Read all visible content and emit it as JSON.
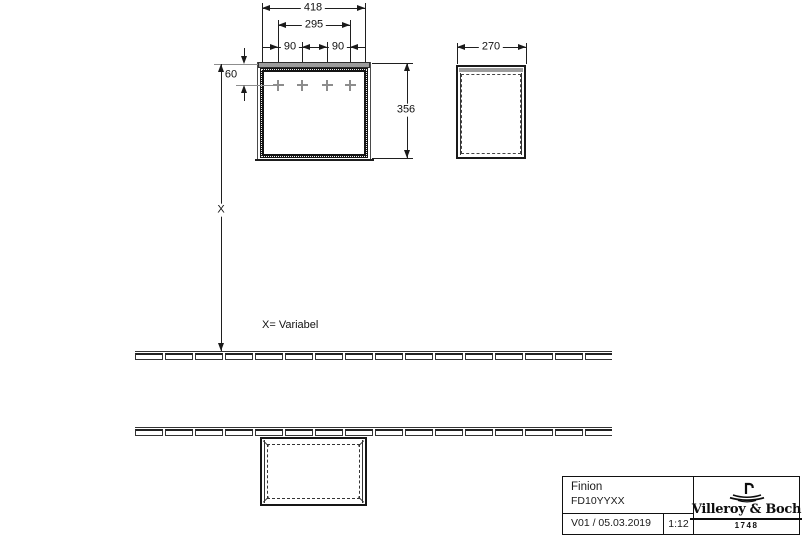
{
  "drawing": {
    "dimensions": {
      "total_width": "418",
      "inner_width": "295",
      "hole_pitch_left": "90",
      "hole_pitch_right": "90",
      "top_offset": "60",
      "height": "356",
      "depth": "270",
      "variable_label": "X",
      "variable_note": "X= Variabel"
    }
  },
  "title_block": {
    "product_name": "Finion",
    "article_number": "FD10YYXX",
    "version_date": "V01 / 05.03.2019",
    "scale": "1:12",
    "brand": "Villeroy & Boch",
    "founding_year": "1748"
  },
  "colors": {
    "line": "#1a1a1a",
    "gray_fill": "#9c9c9c",
    "gray_line": "#8d8d8d",
    "background": "#ffffff"
  }
}
